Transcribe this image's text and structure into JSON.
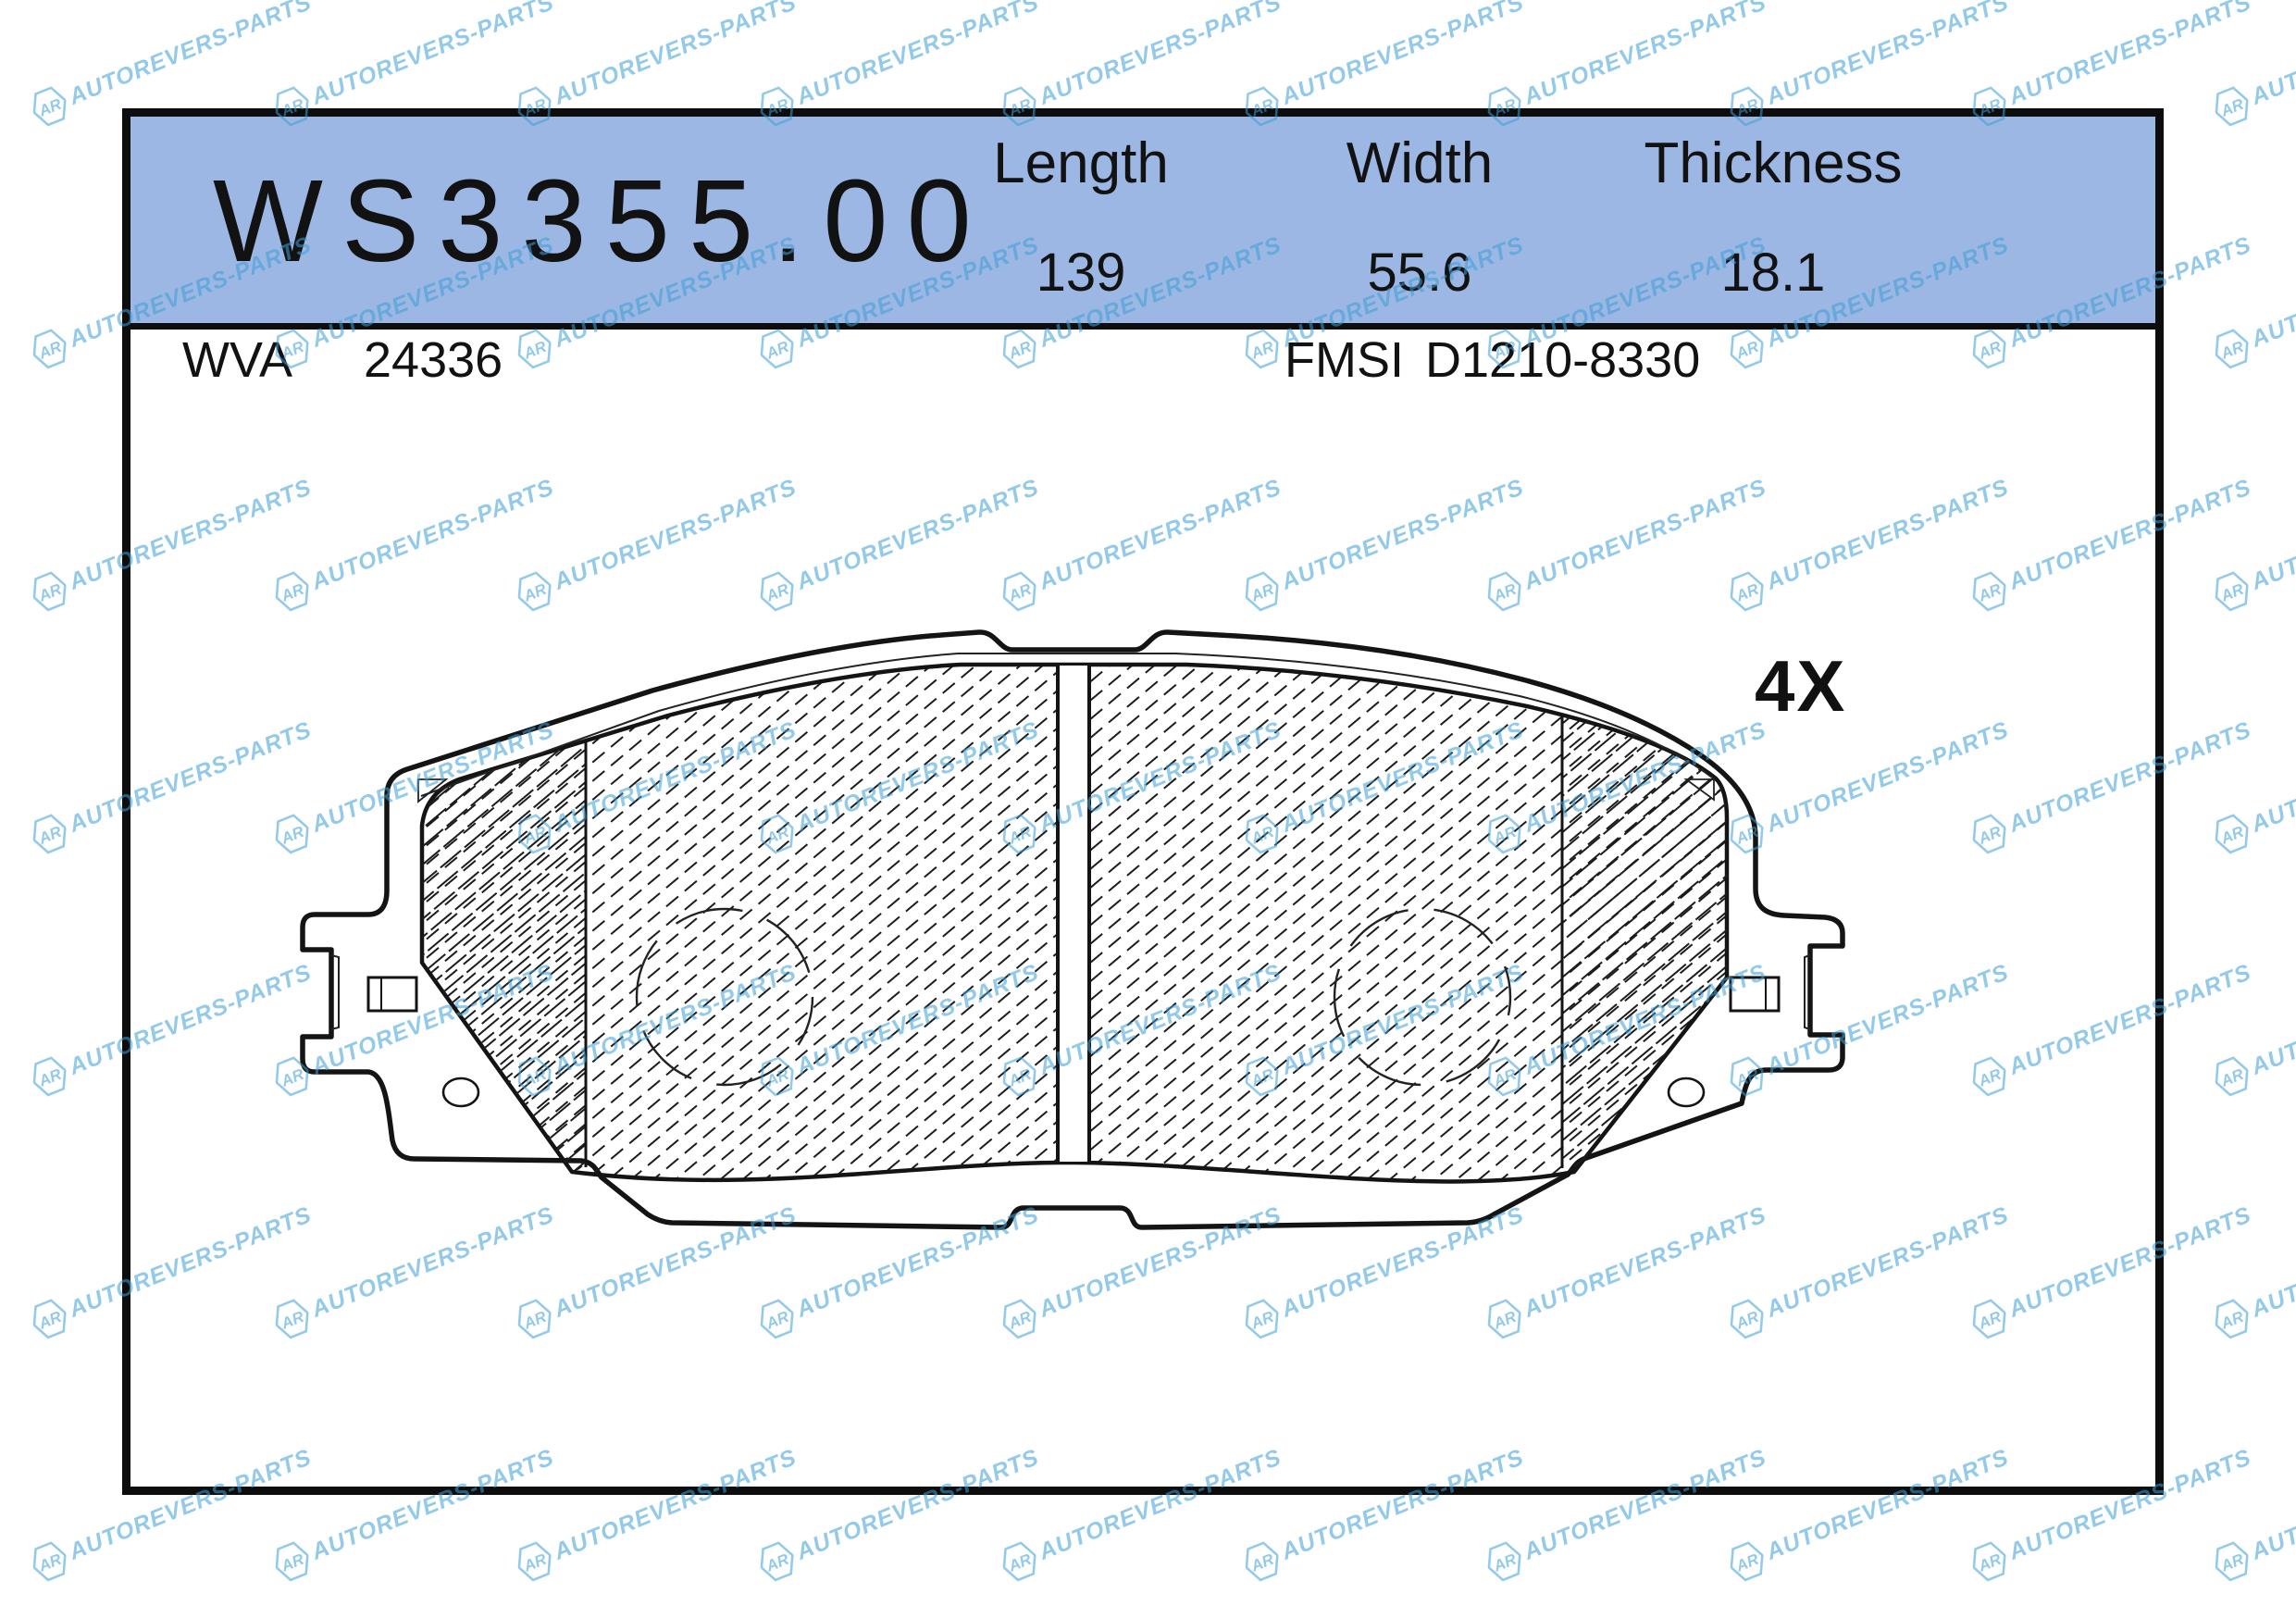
{
  "banner": {
    "part_number": "WS3355.00",
    "columns": [
      {
        "label": "Length",
        "value": "139"
      },
      {
        "label": "Width",
        "value": "55.6"
      },
      {
        "label": "Thickness",
        "value": "18.1"
      }
    ]
  },
  "codes": {
    "wva_label": "WVA",
    "wva_value": "24336",
    "fmsi_label": "FMSI",
    "fmsi_value": "D1210-8330"
  },
  "drawing": {
    "quantity_label": "4X"
  },
  "watermark": {
    "logo_text": "AR",
    "brand_text": "AUTOREVERS-PARTS"
  },
  "colors": {
    "banner_bg": "#9cb7e3",
    "watermark": "#3e9fd8",
    "line": "#141414"
  }
}
